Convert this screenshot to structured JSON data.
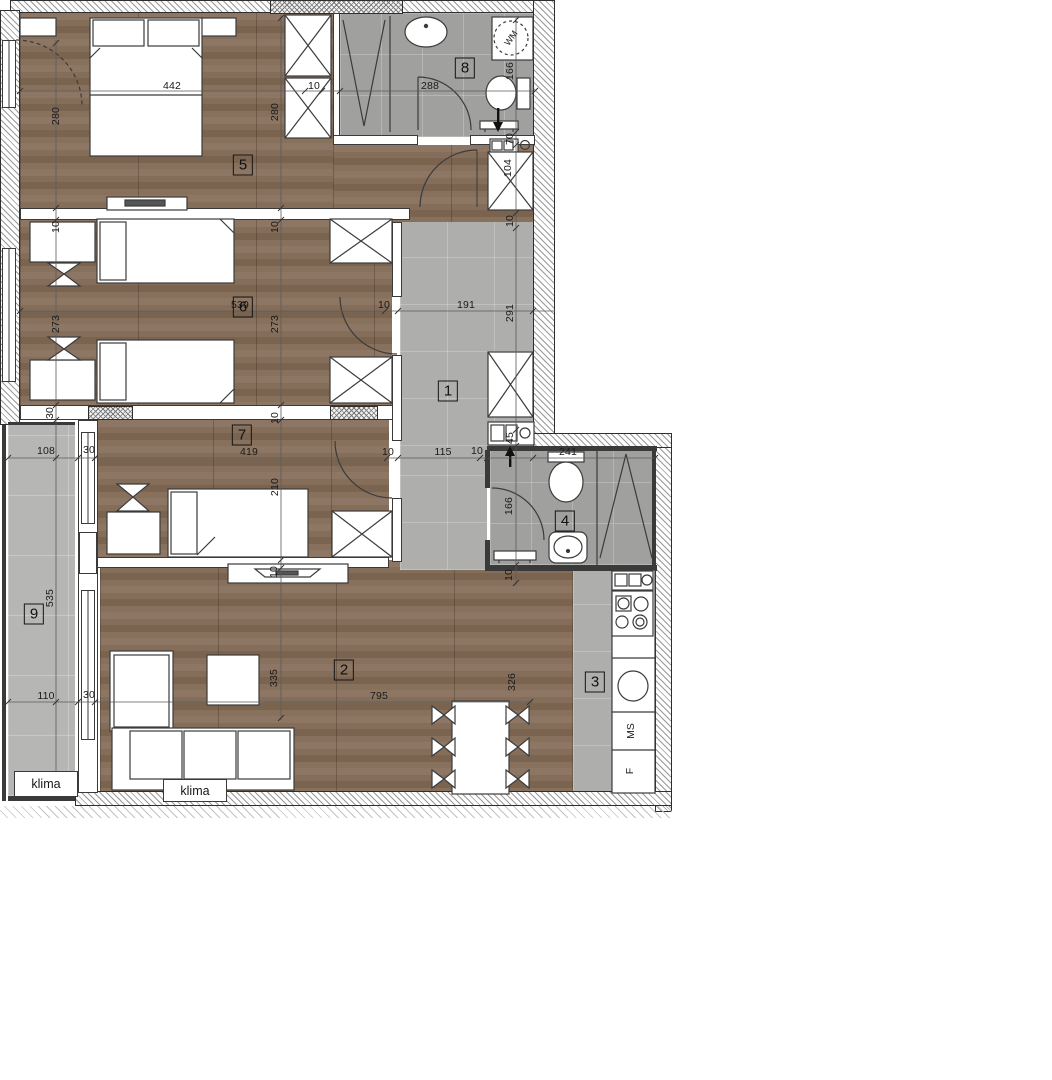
{
  "plan": {
    "rooms": [
      {
        "n": "1",
        "x": 448,
        "y": 391
      },
      {
        "n": "2",
        "x": 344,
        "y": 670
      },
      {
        "n": "3",
        "x": 595,
        "y": 682
      },
      {
        "n": "4",
        "x": 565,
        "y": 521
      },
      {
        "n": "5",
        "x": 243,
        "y": 165
      },
      {
        "n": "6",
        "x": 243,
        "y": 307
      },
      {
        "n": "7",
        "x": 242,
        "y": 435
      },
      {
        "n": "8",
        "x": 465,
        "y": 68
      },
      {
        "n": "9",
        "x": 34,
        "y": 614
      }
    ],
    "dimensions": [
      {
        "t": "442",
        "x": 172,
        "y": 86,
        "v": false
      },
      {
        "t": "280",
        "x": 56,
        "y": 116,
        "v": true
      },
      {
        "t": "280",
        "x": 275,
        "y": 112,
        "v": true
      },
      {
        "t": "10",
        "x": 314,
        "y": 86,
        "v": false
      },
      {
        "t": "288",
        "x": 430,
        "y": 86,
        "v": false
      },
      {
        "t": "166",
        "x": 510,
        "y": 71,
        "v": true
      },
      {
        "t": "70",
        "x": 510,
        "y": 139,
        "v": true
      },
      {
        "t": "104",
        "x": 508,
        "y": 168,
        "v": true
      },
      {
        "t": "10",
        "x": 510,
        "y": 221,
        "v": true
      },
      {
        "t": "10",
        "x": 56,
        "y": 227,
        "v": true
      },
      {
        "t": "273",
        "x": 56,
        "y": 324,
        "v": true
      },
      {
        "t": "539",
        "x": 240,
        "y": 305,
        "v": false
      },
      {
        "t": "273",
        "x": 275,
        "y": 324,
        "v": true
      },
      {
        "t": "10",
        "x": 275,
        "y": 227,
        "v": true
      },
      {
        "t": "10",
        "x": 384,
        "y": 305,
        "v": false
      },
      {
        "t": "191",
        "x": 466,
        "y": 305,
        "v": false
      },
      {
        "t": "291",
        "x": 510,
        "y": 313,
        "v": true
      },
      {
        "t": "30",
        "x": 50,
        "y": 413,
        "v": true
      },
      {
        "t": "108",
        "x": 46,
        "y": 451,
        "v": false
      },
      {
        "t": "30",
        "x": 89,
        "y": 450,
        "v": false
      },
      {
        "t": "419",
        "x": 249,
        "y": 452,
        "v": false
      },
      {
        "t": "10",
        "x": 275,
        "y": 418,
        "v": true
      },
      {
        "t": "210",
        "x": 275,
        "y": 487,
        "v": true
      },
      {
        "t": "10",
        "x": 388,
        "y": 452,
        "v": false
      },
      {
        "t": "115",
        "x": 443,
        "y": 452,
        "v": false
      },
      {
        "t": "10",
        "x": 477,
        "y": 451,
        "v": false
      },
      {
        "t": "45",
        "x": 510,
        "y": 438,
        "v": true
      },
      {
        "t": "241",
        "x": 568,
        "y": 452,
        "v": false
      },
      {
        "t": "166",
        "x": 509,
        "y": 506,
        "v": true
      },
      {
        "t": "10",
        "x": 509,
        "y": 575,
        "v": true
      },
      {
        "t": "535",
        "x": 50,
        "y": 598,
        "v": true
      },
      {
        "t": "110",
        "x": 46,
        "y": 696,
        "v": false
      },
      {
        "t": "30",
        "x": 89,
        "y": 695,
        "v": false
      },
      {
        "t": "335",
        "x": 274,
        "y": 678,
        "v": true
      },
      {
        "t": "795",
        "x": 379,
        "y": 696,
        "v": false
      },
      {
        "t": "326",
        "x": 512,
        "y": 682,
        "v": true
      },
      {
        "t": "10",
        "x": 274,
        "y": 572,
        "v": true
      }
    ],
    "labels": {
      "klima_balcony": "klima",
      "klima_living": "klima",
      "washing_machine": "WM",
      "dishwasher": "MS",
      "fridge": "F"
    },
    "colors": {
      "wood": "#846e5a",
      "tile_bath": "#a0a09e",
      "tile_hall": "#aeaeac",
      "tile_balcony": "#b6b6b4",
      "wall_outline": "#2e2e2e"
    }
  }
}
